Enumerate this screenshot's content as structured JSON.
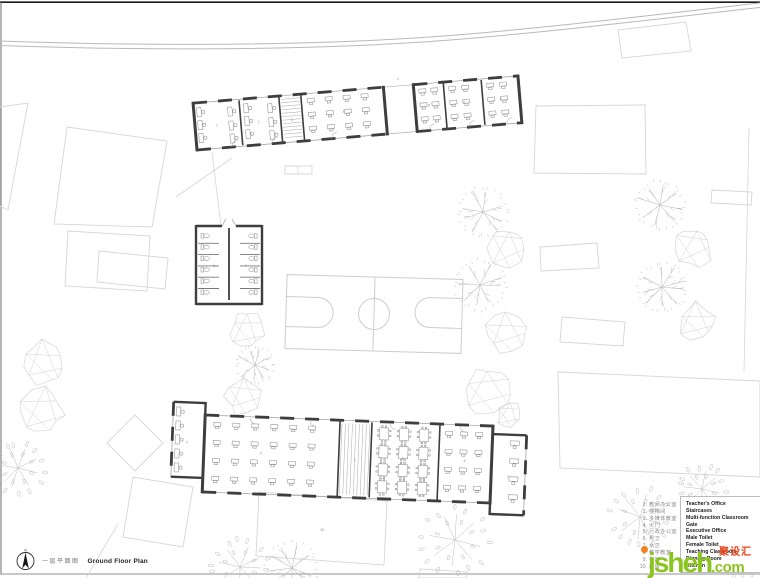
{
  "title_block": {
    "title_zh": "一层平面图",
    "title_en": "Ground Floor Plan"
  },
  "compass": {
    "north_label": "N"
  },
  "legend": {
    "items": [
      {
        "num": "1.",
        "zh": "教师办公室",
        "en": "Teacher's Office"
      },
      {
        "num": "2.",
        "zh": "楼梯间",
        "en": "Staircases"
      },
      {
        "num": "3.",
        "zh": "多媒体教室",
        "en": "Multi-function Classroom"
      },
      {
        "num": "4.",
        "zh": "大门",
        "en": "Gate"
      },
      {
        "num": "5.",
        "zh": "行政办公室",
        "en": "Executive Office"
      },
      {
        "num": "6.",
        "zh": "男卫",
        "en": "Male Toilet"
      },
      {
        "num": "7.",
        "zh": "女卫",
        "en": "Female Toilet"
      },
      {
        "num": "8.",
        "zh": "教学教室",
        "en": "Teaching Classroom"
      },
      {
        "num": "9.",
        "zh": "餐厅",
        "en": "Dinning Room"
      },
      {
        "num": "10.",
        "zh": "厨房",
        "en": "Kitchen"
      }
    ]
  },
  "watermark": {
    "brand_zh": "聚设汇",
    "brand_latin": "jsheh",
    "suffix": ".com",
    "color_green": "#8cc41f",
    "color_red": "#e8441a",
    "color_orange": "#f0831e"
  },
  "plan": {
    "wall_color": "#3e3e3e",
    "room_labels": {
      "office_a": "1",
      "office_b": "1",
      "stair_north": "2",
      "multi_classroom": "3",
      "gate": "4",
      "classroom_n1": "8",
      "classroom_n2": "8",
      "classroom_n3": "8",
      "male_toilet": "6",
      "female_toilet": "7",
      "exec_office": "5",
      "classroom_s": "8",
      "stair_south": "2",
      "dining": "9",
      "classroom_s2": "8",
      "office_s": "1",
      "yard": "10"
    }
  }
}
